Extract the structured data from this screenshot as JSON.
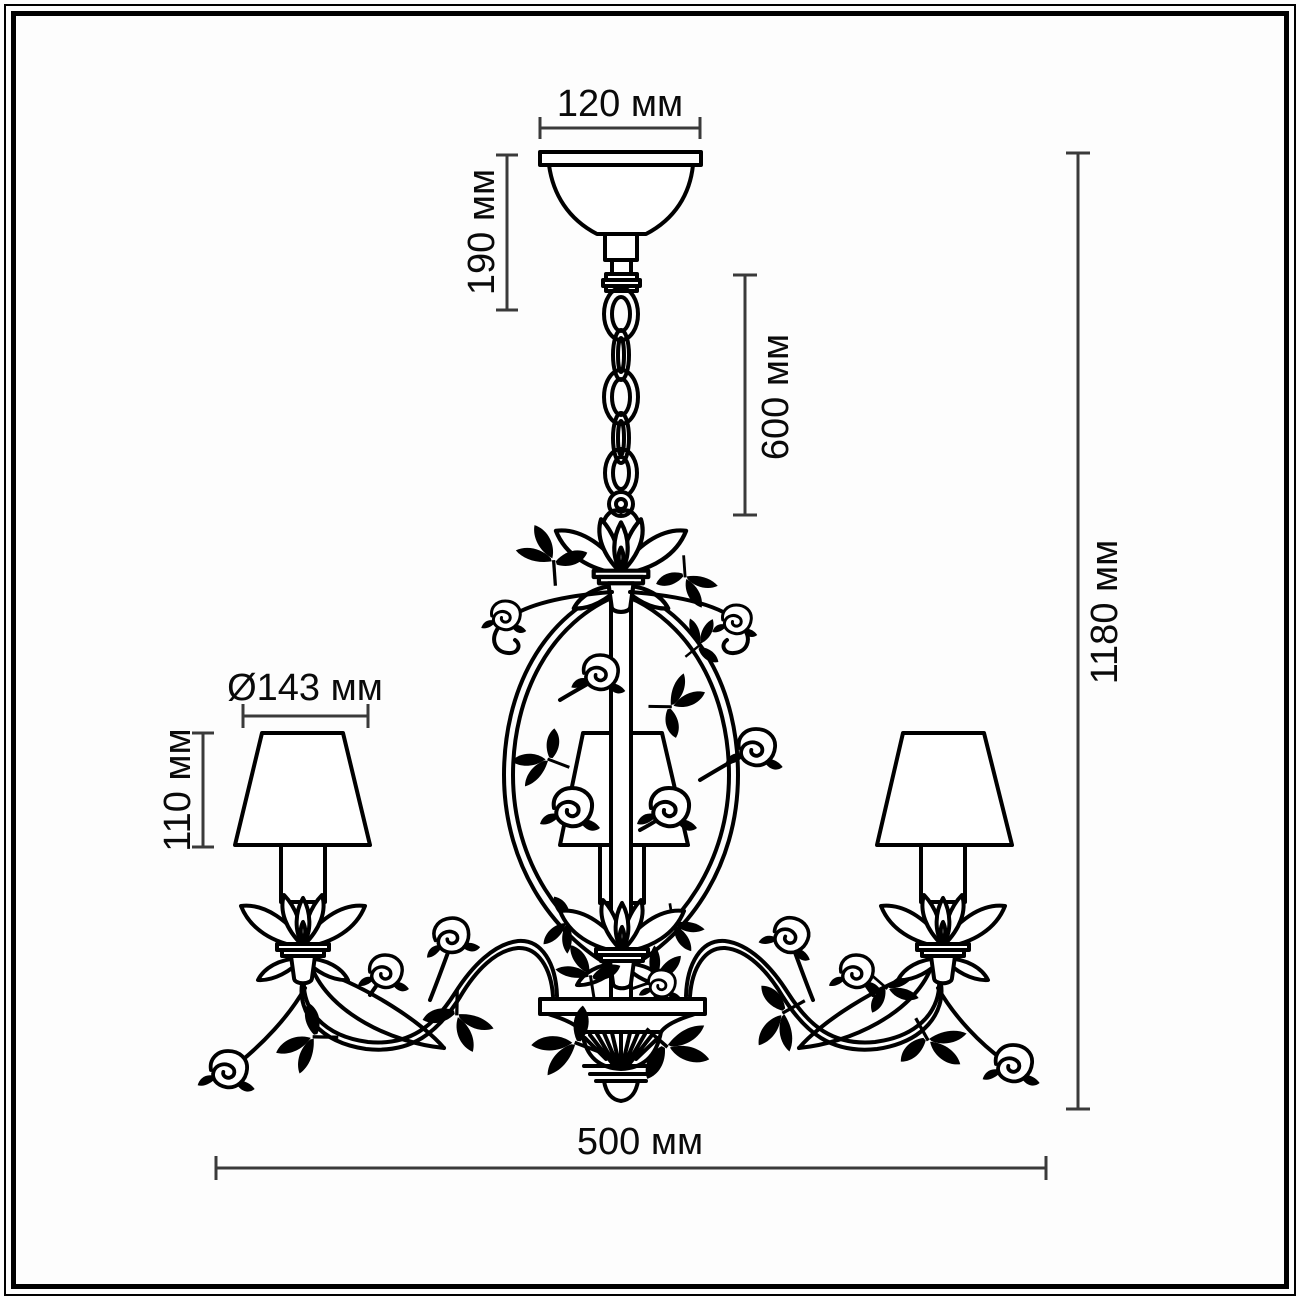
{
  "diagram": {
    "subject": "chandelier dimension drawing",
    "unit": "мм",
    "lampshade_count": 3,
    "colors": {
      "line": "#000000",
      "dimension_line": "#3a3a3a",
      "background": "#ffffff"
    },
    "dimensions": {
      "canopy_width": "120 мм",
      "canopy_drop": "190 мм",
      "chain_length": "600 мм",
      "total_height": "1180 мм",
      "shade_diameter": "Ø143 мм",
      "shade_height": "110 мм",
      "total_width": "500 мм"
    }
  }
}
